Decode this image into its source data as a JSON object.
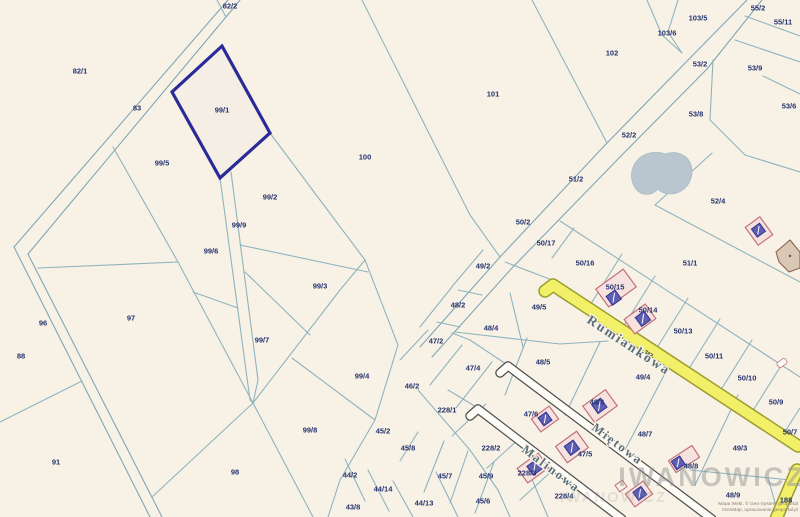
{
  "map": {
    "selected_parcel": "99/1",
    "colors": {
      "background": "#f8f2e6",
      "boundary_line": "#8fb3bf",
      "road_line": "#7fa6b5",
      "selected_outline": "#2a2a99",
      "label_text": "#25336f",
      "street_text": "#5a6e78",
      "road_yellow_fill": "#f2ef69",
      "road_yellow_edge": "#9c9c30",
      "road_white_fill": "#fdfcf7",
      "road_white_edge": "#4f4f4f",
      "pond": "#b9c6cf",
      "house_plot_fill": "#f6e3df",
      "house_plot_edge": "#c4707a",
      "building_fill": "#5e5eb2",
      "building_edge": "#343492",
      "watermark": "#969696"
    },
    "watermark": {
      "primary": "IWANOWICZ",
      "secondary": "IWANOWICZ"
    },
    "credits": {
      "line1": "Mapa Wekt. © Geo-System geoportal",
      "line2": "iGeoMap, opracowanie geoportal.pl"
    },
    "streets": [
      {
        "name": "Rumiankowa",
        "x": 586,
        "y": 322,
        "angle": 33.4,
        "size": 13.5
      },
      {
        "name": "Miętowa",
        "x": 591,
        "y": 429,
        "angle": 36.9,
        "size": 12.5
      },
      {
        "name": "Malinowa",
        "x": 521,
        "y": 451,
        "angle": 37.0,
        "size": 12.5
      }
    ],
    "parcel_labels": [
      {
        "id": "82/2",
        "x": 230,
        "y": 6
      },
      {
        "id": "82/1",
        "x": 80,
        "y": 71
      },
      {
        "id": "83",
        "x": 137,
        "y": 108
      },
      {
        "id": "99/1",
        "x": 222,
        "y": 110
      },
      {
        "id": "99/5",
        "x": 162,
        "y": 163
      },
      {
        "id": "100",
        "x": 365,
        "y": 157
      },
      {
        "id": "101",
        "x": 493,
        "y": 94
      },
      {
        "id": "102",
        "x": 612,
        "y": 53
      },
      {
        "id": "103/5",
        "x": 698,
        "y": 18
      },
      {
        "id": "103/6",
        "x": 667,
        "y": 33
      },
      {
        "id": "55/2",
        "x": 758,
        "y": 8
      },
      {
        "id": "55/11",
        "x": 783,
        "y": 22
      },
      {
        "id": "53/2",
        "x": 700,
        "y": 64
      },
      {
        "id": "53/9",
        "x": 755,
        "y": 68
      },
      {
        "id": "53/8",
        "x": 696,
        "y": 114
      },
      {
        "id": "53/6",
        "x": 789,
        "y": 106
      },
      {
        "id": "52/2",
        "x": 629,
        "y": 135
      },
      {
        "id": "51/2",
        "x": 576,
        "y": 179
      },
      {
        "id": "52/4",
        "x": 718,
        "y": 201
      },
      {
        "id": "51/1",
        "x": 690,
        "y": 263
      },
      {
        "id": "99/2",
        "x": 270,
        "y": 197
      },
      {
        "id": "99/9",
        "x": 239,
        "y": 225
      },
      {
        "id": "99/6",
        "x": 211,
        "y": 251
      },
      {
        "id": "99/3",
        "x": 320,
        "y": 286
      },
      {
        "id": "99/7",
        "x": 262,
        "y": 340
      },
      {
        "id": "99/4",
        "x": 362,
        "y": 376
      },
      {
        "id": "99/8",
        "x": 310,
        "y": 430
      },
      {
        "id": "96",
        "x": 43,
        "y": 323
      },
      {
        "id": "97",
        "x": 131,
        "y": 318
      },
      {
        "id": "88",
        "x": 21,
        "y": 356
      },
      {
        "id": "91",
        "x": 56,
        "y": 462
      },
      {
        "id": "98",
        "x": 235,
        "y": 472
      },
      {
        "id": "50/2",
        "x": 523,
        "y": 222
      },
      {
        "id": "50/17",
        "x": 546,
        "y": 243
      },
      {
        "id": "50/16",
        "x": 585,
        "y": 263
      },
      {
        "id": "50/15",
        "x": 615,
        "y": 287
      },
      {
        "id": "50/14",
        "x": 648,
        "y": 310
      },
      {
        "id": "50/13",
        "x": 683,
        "y": 331
      },
      {
        "id": "50/11",
        "x": 714,
        "y": 356
      },
      {
        "id": "50/10",
        "x": 747,
        "y": 378
      },
      {
        "id": "50/9",
        "x": 776,
        "y": 402
      },
      {
        "id": "50/7",
        "x": 790,
        "y": 432
      },
      {
        "id": "49/2",
        "x": 483,
        "y": 266
      },
      {
        "id": "48/2",
        "x": 458,
        "y": 305
      },
      {
        "id": "49/5",
        "x": 539,
        "y": 307
      },
      {
        "id": "48/4",
        "x": 491,
        "y": 328
      },
      {
        "id": "48/5",
        "x": 543,
        "y": 362
      },
      {
        "id": "47/2",
        "x": 436,
        "y": 341
      },
      {
        "id": "47/4",
        "x": 473,
        "y": 368
      },
      {
        "id": "46/2",
        "x": 412,
        "y": 386
      },
      {
        "id": "49/4",
        "x": 643,
        "y": 377
      },
      {
        "id": "48/7",
        "x": 645,
        "y": 434
      },
      {
        "id": "49/3",
        "x": 740,
        "y": 448
      },
      {
        "id": "48/6",
        "x": 597,
        "y": 402
      },
      {
        "id": "47/6",
        "x": 531,
        "y": 414
      },
      {
        "id": "47/5",
        "x": 585,
        "y": 454
      },
      {
        "id": "48/8",
        "x": 691,
        "y": 466
      },
      {
        "id": "48/9",
        "x": 733,
        "y": 495
      },
      {
        "id": "188",
        "x": 786,
        "y": 500
      },
      {
        "id": "228/1",
        "x": 447,
        "y": 410
      },
      {
        "id": "228/2",
        "x": 491,
        "y": 448
      },
      {
        "id": "228/3",
        "x": 527,
        "y": 473
      },
      {
        "id": "228/4",
        "x": 564,
        "y": 496
      },
      {
        "id": "45/8",
        "x": 408,
        "y": 448
      },
      {
        "id": "45/7",
        "x": 445,
        "y": 476
      },
      {
        "id": "45/9",
        "x": 486,
        "y": 476
      },
      {
        "id": "45/2",
        "x": 383,
        "y": 431
      },
      {
        "id": "45/6",
        "x": 483,
        "y": 501
      },
      {
        "id": "44/2",
        "x": 350,
        "y": 475
      },
      {
        "id": "44/14",
        "x": 383,
        "y": 489
      },
      {
        "id": "43/8",
        "x": 353,
        "y": 507
      },
      {
        "id": "44/13",
        "x": 424,
        "y": 503
      },
      {
        "id": "232",
        "x": 649,
        "y": 353,
        "size": 5.5,
        "angle": 33.4
      }
    ]
  }
}
